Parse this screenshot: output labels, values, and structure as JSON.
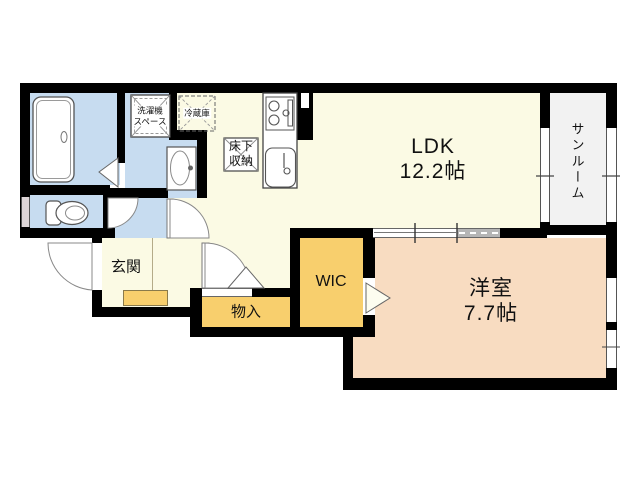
{
  "plan": {
    "title": "apartment-floor-plan",
    "rooms": {
      "ldk": {
        "label": "LDK",
        "size": "12.2帖"
      },
      "western_room": {
        "label": "洋室",
        "size": "7.7帖"
      },
      "sunroom": {
        "label": "サンルーム"
      },
      "wic": {
        "label": "WIC"
      },
      "storage": {
        "label": "物入"
      },
      "entrance": {
        "label": "玄関"
      },
      "underfloor_storage": {
        "line1": "床下",
        "line2": "収納"
      },
      "washer_space": {
        "line1": "洗濯機",
        "line2": "スペース"
      },
      "refrigerator": {
        "label": "冷蔵庫"
      }
    },
    "colors": {
      "wall": "#000000",
      "water": "#c7dcf0",
      "living": "#fbfae4",
      "storage": "#f8cf6d",
      "bedroom": "#f8dcc1",
      "sunroom": "#f2f2f2"
    }
  }
}
